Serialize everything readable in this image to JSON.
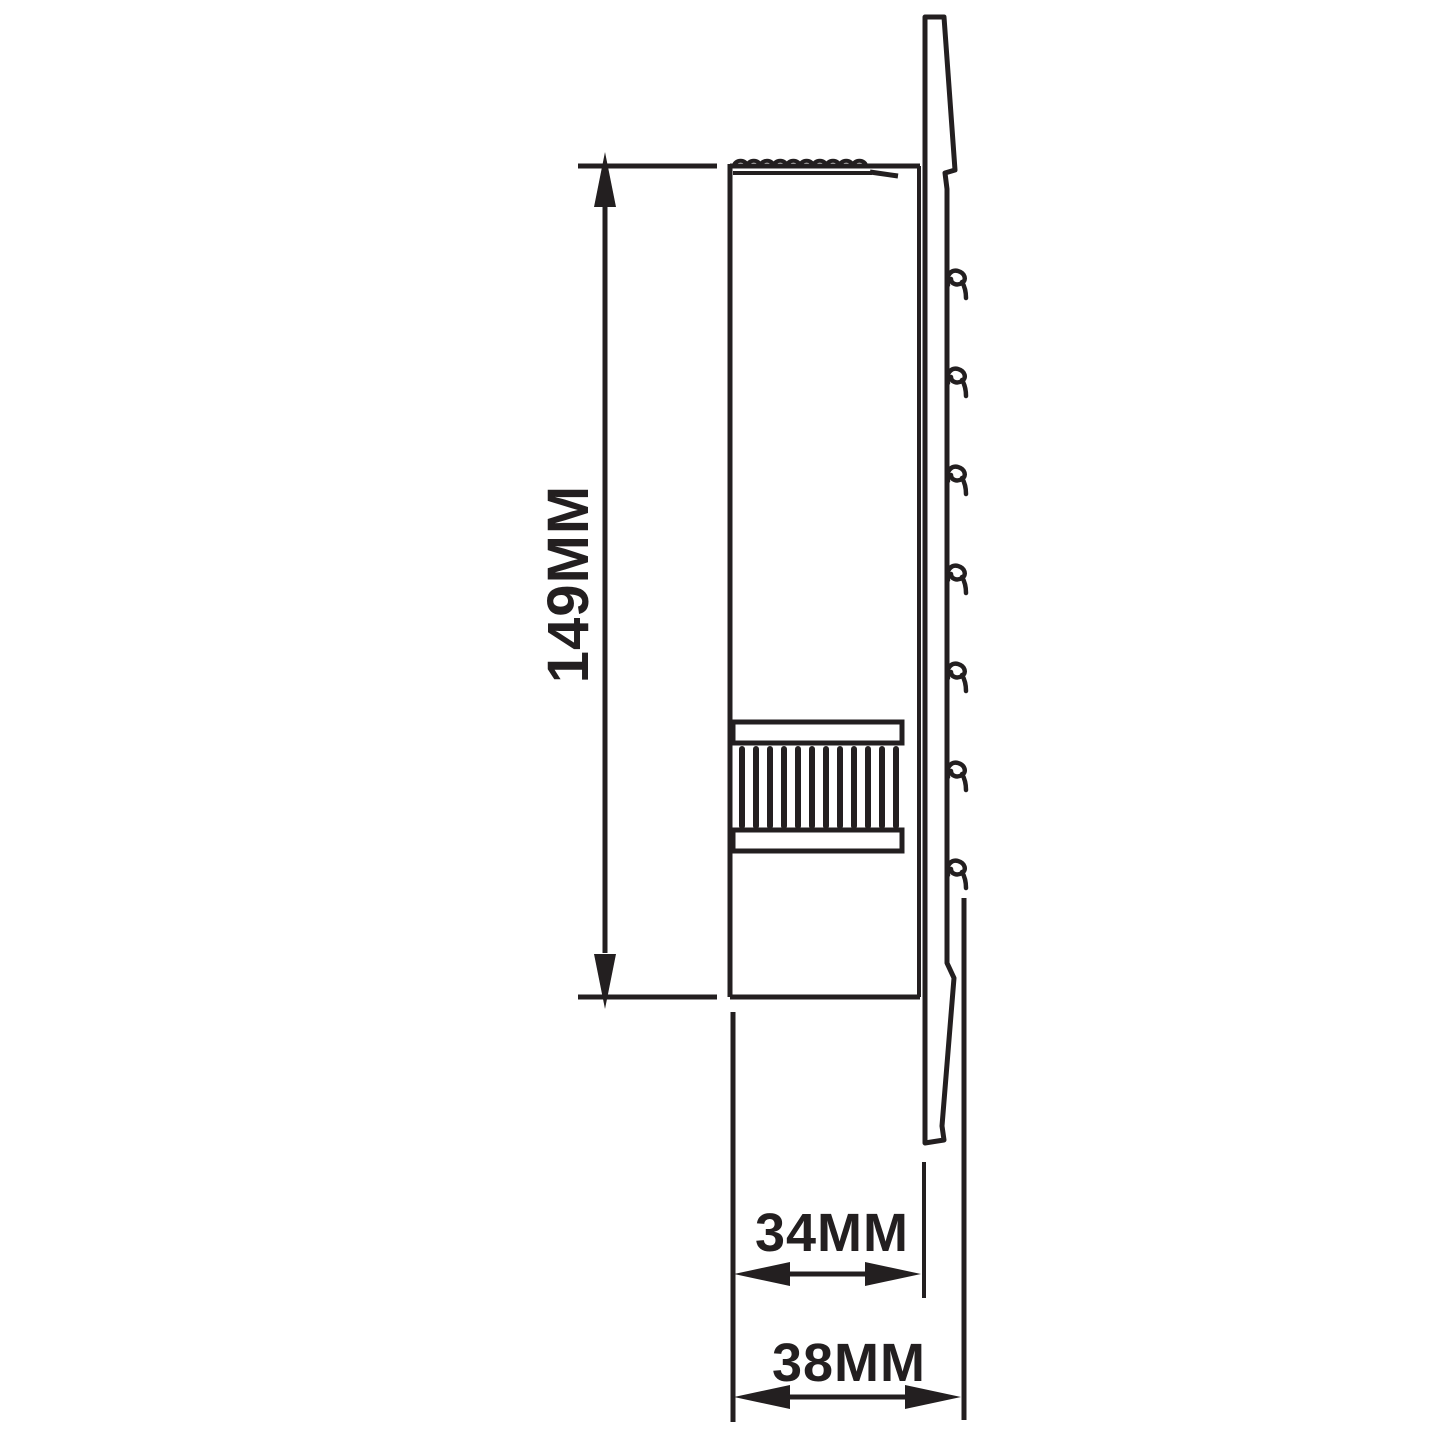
{
  "colors": {
    "ink": "#231f20",
    "background": "#ffffff"
  },
  "diagram": {
    "type": "technical-dimension-drawing",
    "view": "side-profile-line-drawing",
    "dimensions": [
      {
        "label": "149MM",
        "orientation": "vertical"
      },
      {
        "label": "34MM",
        "orientation": "horizontal"
      },
      {
        "label": "38MM",
        "orientation": "horizontal"
      }
    ]
  }
}
